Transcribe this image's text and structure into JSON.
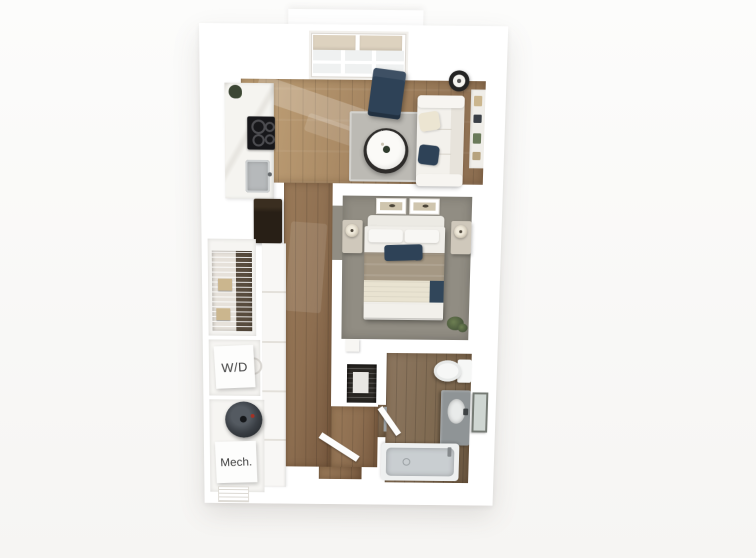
{
  "floorplan": {
    "labels": {
      "washer_dryer": "W/D",
      "mechanical": "Mech."
    },
    "colors": {
      "background": "#fcfcfb",
      "wall": "#ffffff",
      "wall_shadow": "#e8e5e1",
      "wood_living": "#a3835f",
      "wood_living_light": "#c2a379",
      "wood_hall": "#8d6e50",
      "wood_bath": "#7e6950",
      "carpet": "#918d83",
      "rug": "#bcbab4",
      "navy": "#2e4257",
      "sofa": "#f3f1ec",
      "sofa_back": "#e7e3db",
      "counter": "#f5f4f0",
      "cooktop": "#17171a",
      "steel": "#b6b9bb",
      "fridge": "#281f16",
      "cabinet": "#f8f7f5",
      "beige_box": "#cbb68e",
      "closet_dark": "#2b2824",
      "duvet": "#a59884",
      "tub_rim": "#eef0f0",
      "tub_basin": "#c9ced1",
      "vanity": "#8f9496",
      "mirror": "#757a74",
      "heater": "#3a3f45",
      "porcelain": "#f6f7f6",
      "shade_beige": "#ddd2bf",
      "glass": "#eff1f1",
      "lamp_dark": "#232323",
      "label_text": "#3f3f3f",
      "plant": "#5d6f48"
    },
    "rooms": [
      "living-area",
      "kitchen",
      "bedroom",
      "bathroom",
      "walk-in-closet",
      "washer-dryer-closet",
      "mechanical-room",
      "entry-hall"
    ],
    "furniture": [
      "window-with-roller-shades",
      "accent-chair",
      "floor-lamp",
      "sofa",
      "throw-pillows",
      "coffee-table",
      "area-rug",
      "wall-shelf",
      "cooktop",
      "kitchen-sink",
      "refrigerator",
      "base-cabinets",
      "wire-shelving",
      "storage-boxes",
      "washer-dryer-unit",
      "water-heater",
      "bed",
      "headboard",
      "nightstands",
      "table-lamps",
      "wall-art",
      "bed-bench",
      "potted-plant",
      "linen-shelf",
      "toilet",
      "vanity-with-sink",
      "mirror",
      "bathtub",
      "entry-door",
      "bathroom-door",
      "hvac-vent"
    ]
  }
}
